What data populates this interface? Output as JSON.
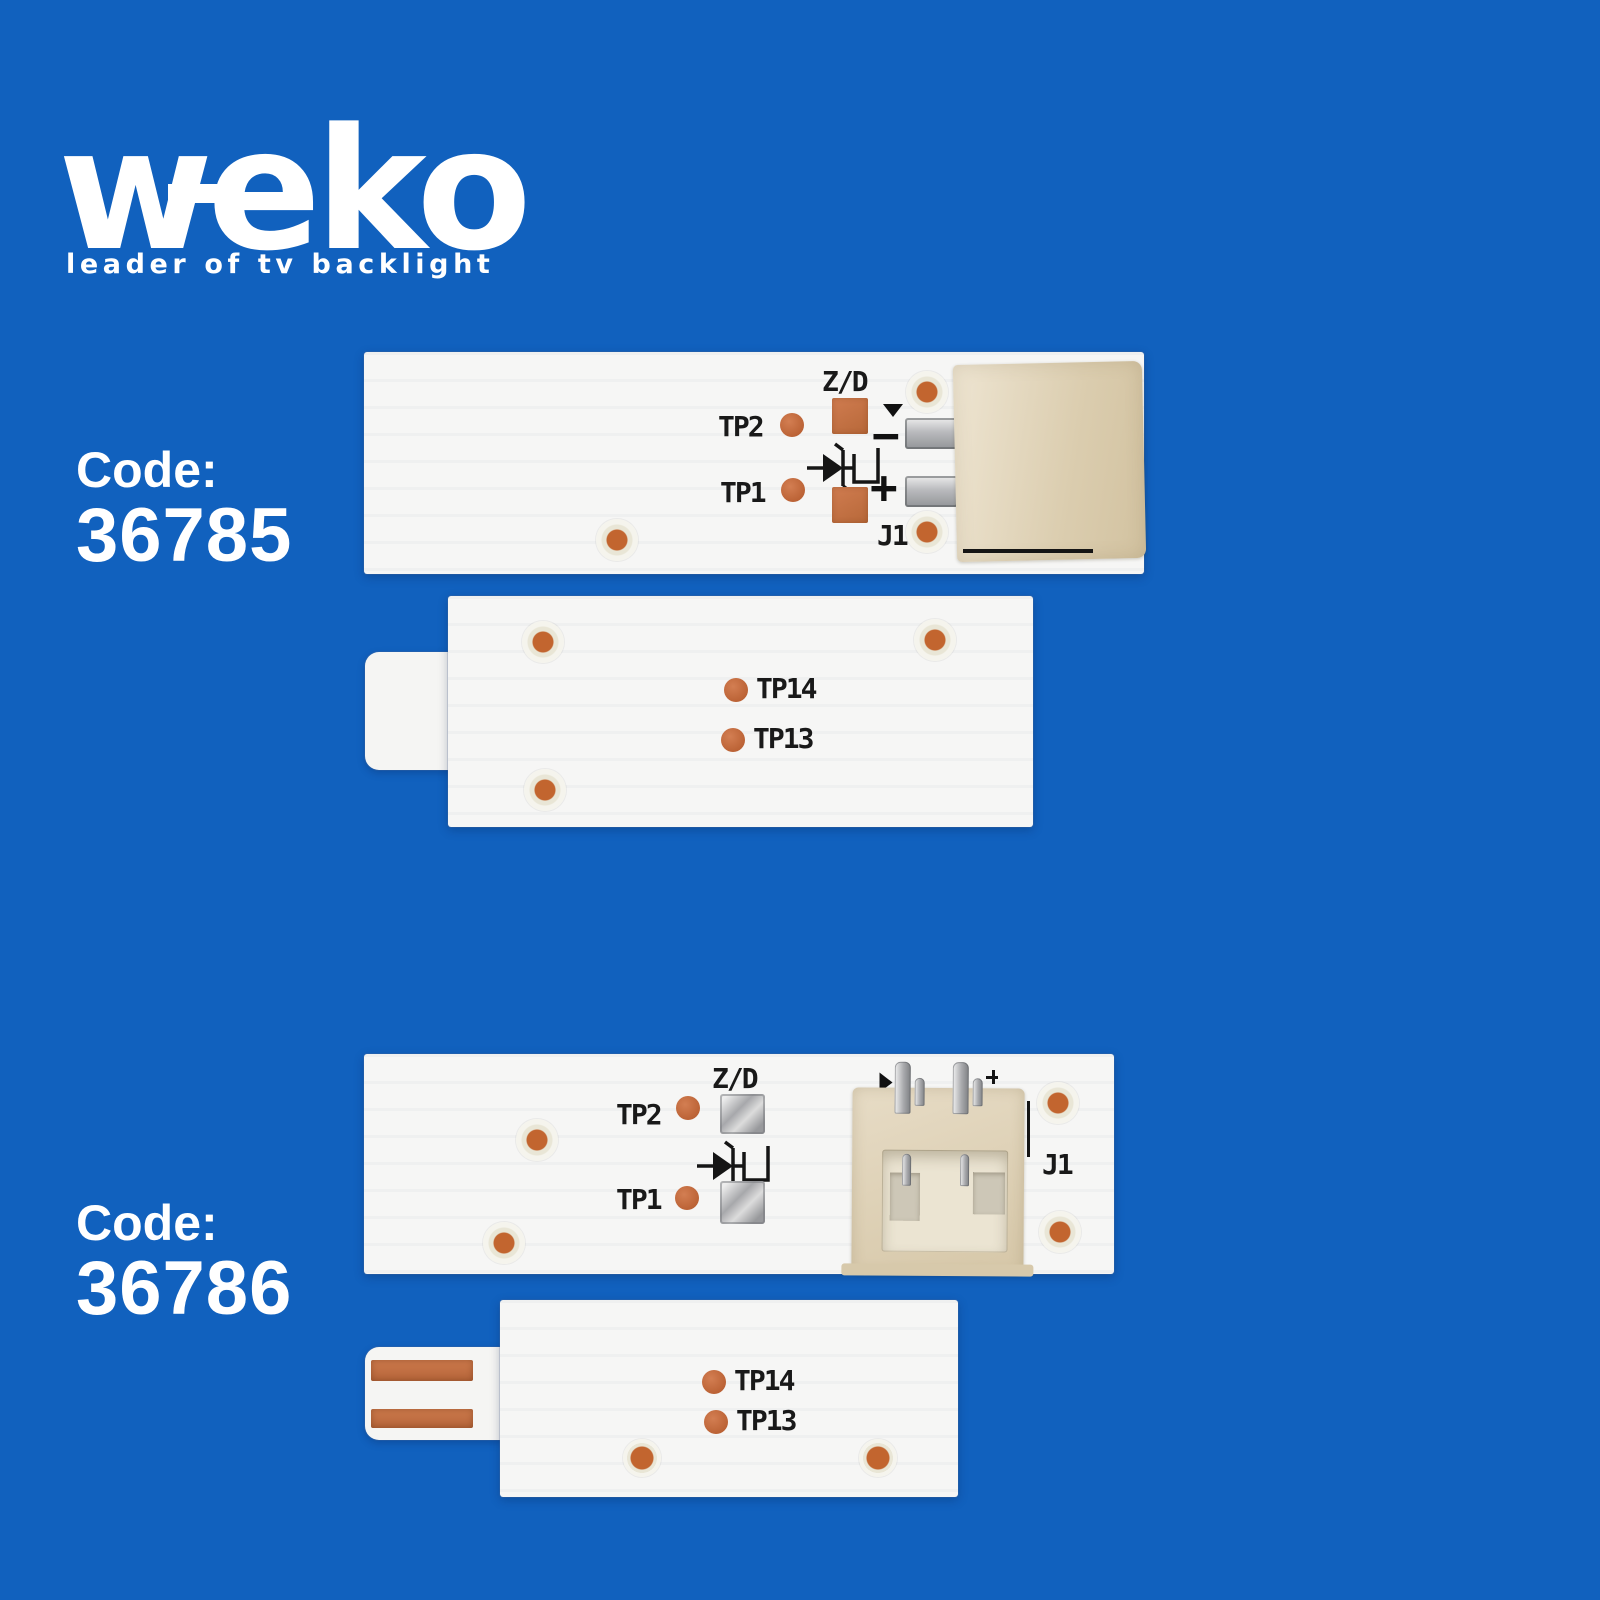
{
  "background_color": "#1161be",
  "logo": {
    "text": "weko",
    "tagline": "leader of tv backlight"
  },
  "products": [
    {
      "code_label": "Code:",
      "code_value": "36785",
      "main_strip": {
        "zener_label": "Z/D",
        "tp2": "TP2",
        "tp1": "TP1",
        "designator": "J1",
        "plus": "+",
        "minus": "−"
      },
      "secondary_strip": {
        "tp14": "TP14",
        "tp13": "TP13"
      }
    },
    {
      "code_label": "Code:",
      "code_value": "36786",
      "main_strip": {
        "zener_label": "Z/D",
        "tp2": "TP2",
        "tp1": "TP1",
        "designator": "J1"
      },
      "secondary_strip": {
        "tp14": "TP14",
        "tp13": "TP13"
      }
    }
  ],
  "colors": {
    "background": "#1161be",
    "pcb_white": "#f6f6f5",
    "copper": "#c06a3c",
    "connector_beige": "#ddd0b4",
    "solder_silver": "#b9babd",
    "silkscreen_black": "#191919",
    "text_white": "#ffffff"
  }
}
